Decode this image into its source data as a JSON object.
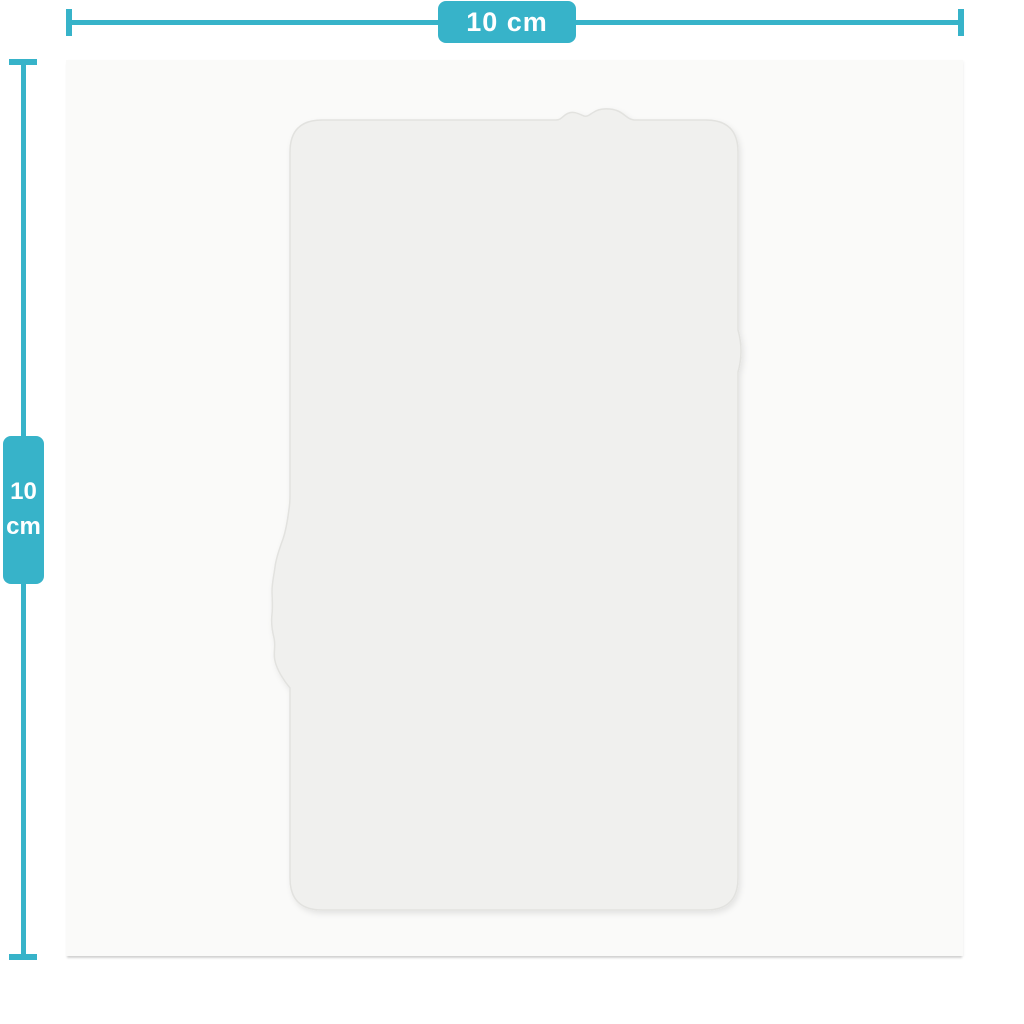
{
  "colors": {
    "accent": "#37b3c9",
    "background": "#ffffff",
    "card": "#fafaf9",
    "film_fill": "#f0f0ee",
    "film_edge": "#e2e2df",
    "label_text": "#ffffff"
  },
  "dimension_annotations": {
    "width": {
      "label": "10 cm"
    },
    "height": {
      "value": "10",
      "unit": "cm"
    }
  }
}
